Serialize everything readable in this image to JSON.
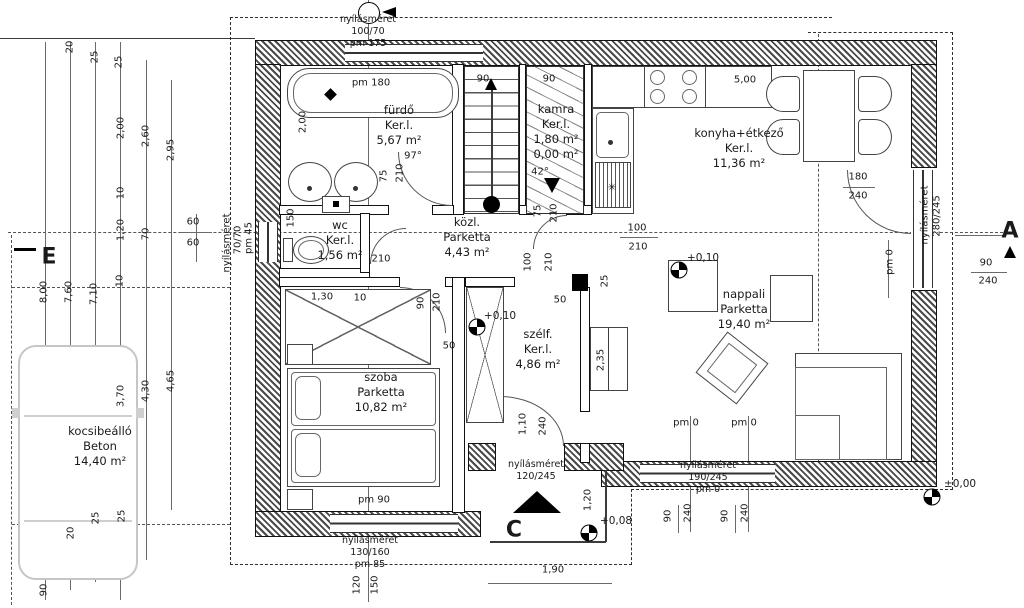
{
  "colors": {
    "line": "#1a1a1a",
    "wall_hatch": "#4a4a4a",
    "car_outline": "#c6c6c6"
  },
  "rooms": [
    {
      "name": "fürdő",
      "floor": "Ker.l.",
      "area": "5,67 m²",
      "x": 399,
      "y": 103
    },
    {
      "name": "wc",
      "floor": "Ker.l.",
      "area": "1,56 m²",
      "x": 340,
      "y": 218
    },
    {
      "name": "kamra",
      "floor": "Ker.l.",
      "area": "1,80 m²",
      "extra": "0,00 m²",
      "x": 556,
      "y": 102
    },
    {
      "name": "konyha+étkező",
      "floor": "Ker.l.",
      "area": "11,36 m²",
      "x": 739,
      "y": 126
    },
    {
      "name": "közl.",
      "floor": "Parketta",
      "area": "4,43 m²",
      "x": 467,
      "y": 215
    },
    {
      "name": "szélf.",
      "floor": "Ker.l.",
      "area": "4,86 m²",
      "x": 538,
      "y": 327
    },
    {
      "name": "nappali",
      "floor": "Parketta",
      "area": "19,40 m²",
      "x": 744,
      "y": 287
    },
    {
      "name": "szoba",
      "floor": "Parketta",
      "area": "10,82 m²",
      "x": 381,
      "y": 370
    },
    {
      "name": "kocsibeálló",
      "floor": "Beton",
      "area": "14,40 m²",
      "x": 100,
      "y": 424
    }
  ],
  "opening_notes": [
    {
      "lines": [
        "nyílásméret",
        "100/70",
        "pm 175"
      ],
      "x": 368,
      "y": 14
    },
    {
      "lines": [
        "nyílásméret",
        "130/160",
        "pm 85"
      ],
      "x": 370,
      "y": 535
    },
    {
      "lines": [
        "nyílásméret",
        "120/245"
      ],
      "x": 536,
      "y": 459
    },
    {
      "lines": [
        "nyílásméret",
        "190/245",
        "pm 0"
      ],
      "x": 708,
      "y": 460
    }
  ],
  "dims_h": [
    {
      "t": "60",
      "x": 193,
      "y": 222
    },
    {
      "t": "60",
      "x": 193,
      "y": 243
    },
    {
      "t": "90",
      "x": 483,
      "y": 79
    },
    {
      "t": "90",
      "x": 549,
      "y": 79
    },
    {
      "t": "5,00",
      "x": 745,
      "y": 80
    },
    {
      "t": "42°",
      "x": 540,
      "y": 172
    },
    {
      "t": "97°",
      "x": 413,
      "y": 156
    },
    {
      "t": "pm 180",
      "x": 371,
      "y": 83
    },
    {
      "t": "pm 90",
      "x": 374,
      "y": 500
    },
    {
      "t": "pm 0",
      "x": 686,
      "y": 423
    },
    {
      "t": "pm 0",
      "x": 744,
      "y": 423
    },
    {
      "t": "100",
      "x": 637,
      "y": 228
    },
    {
      "t": "210",
      "x": 638,
      "y": 247
    },
    {
      "t": "180",
      "x": 858,
      "y": 177
    },
    {
      "t": "240",
      "x": 858,
      "y": 196
    },
    {
      "t": "90",
      "x": 986,
      "y": 263
    },
    {
      "t": "240",
      "x": 988,
      "y": 281
    },
    {
      "t": "50",
      "x": 560,
      "y": 300
    },
    {
      "t": "50",
      "x": 449,
      "y": 346
    },
    {
      "t": "1,30",
      "x": 322,
      "y": 297
    },
    {
      "t": "10",
      "x": 360,
      "y": 298
    },
    {
      "t": "210",
      "x": 381,
      "y": 259
    },
    {
      "t": "1,90",
      "x": 553,
      "y": 570
    },
    {
      "t": "✳",
      "x": 612,
      "y": 188
    }
  ],
  "dims_v": [
    {
      "t": "20",
      "x": 70,
      "y": 47
    },
    {
      "t": "25",
      "x": 95,
      "y": 57
    },
    {
      "t": "25",
      "x": 119,
      "y": 62
    },
    {
      "t": "2,00",
      "x": 121,
      "y": 128
    },
    {
      "t": "2,60",
      "x": 146,
      "y": 136
    },
    {
      "t": "2,95",
      "x": 171,
      "y": 150
    },
    {
      "t": "10",
      "x": 121,
      "y": 193
    },
    {
      "t": "1,20",
      "x": 121,
      "y": 230
    },
    {
      "t": "70",
      "x": 146,
      "y": 234
    },
    {
      "t": "10",
      "x": 120,
      "y": 281
    },
    {
      "t": "8,00",
      "x": 44,
      "y": 292
    },
    {
      "t": "7,60",
      "x": 69,
      "y": 292
    },
    {
      "t": "7,10",
      "x": 94,
      "y": 294
    },
    {
      "t": "3,70",
      "x": 121,
      "y": 396
    },
    {
      "t": "4,30",
      "x": 146,
      "y": 391
    },
    {
      "t": "4,65",
      "x": 171,
      "y": 381
    },
    {
      "t": "20",
      "x": 71,
      "y": 533
    },
    {
      "t": "25",
      "x": 96,
      "y": 518
    },
    {
      "t": "25",
      "x": 122,
      "y": 516
    },
    {
      "t": "90",
      "x": 44,
      "y": 590
    },
    {
      "t": "120",
      "x": 357,
      "y": 585
    },
    {
      "t": "150",
      "x": 375,
      "y": 585
    },
    {
      "t": "2,00",
      "x": 303,
      "y": 122
    },
    {
      "t": "75",
      "x": 384,
      "y": 176
    },
    {
      "t": "210",
      "x": 400,
      "y": 173
    },
    {
      "t": "150",
      "x": 291,
      "y": 218
    },
    {
      "t": "90",
      "x": 421,
      "y": 303
    },
    {
      "t": "210",
      "x": 437,
      "y": 302
    },
    {
      "t": "75",
      "x": 538,
      "y": 211
    },
    {
      "t": "210",
      "x": 554,
      "y": 213
    },
    {
      "t": "100",
      "x": 528,
      "y": 262
    },
    {
      "t": "210",
      "x": 549,
      "y": 262
    },
    {
      "t": "25",
      "x": 605,
      "y": 281
    },
    {
      "t": "2,35",
      "x": 601,
      "y": 360
    },
    {
      "t": "1,10",
      "x": 523,
      "y": 424
    },
    {
      "t": "240",
      "x": 543,
      "y": 426
    },
    {
      "t": "1,20",
      "x": 588,
      "y": 500
    },
    {
      "t": "90",
      "x": 668,
      "y": 516
    },
    {
      "t": "240",
      "x": 688,
      "y": 513
    },
    {
      "t": "90",
      "x": 725,
      "y": 516
    },
    {
      "t": "240",
      "x": 745,
      "y": 513
    },
    {
      "t": "pm 0",
      "x": 890,
      "y": 262
    },
    {
      "t": "nyílásméret",
      "x": 227,
      "y": 243
    },
    {
      "t": "70/70",
      "x": 238,
      "y": 240
    },
    {
      "t": "pm 45",
      "x": 249,
      "y": 238
    },
    {
      "t": "nyílásméret",
      "x": 925,
      "y": 215
    },
    {
      "t": "280/245",
      "x": 937,
      "y": 216
    }
  ],
  "levels": [
    {
      "t": "+0,10",
      "tx": 703,
      "ty": 258,
      "cx": 679,
      "cy": 270
    },
    {
      "t": "+0,10",
      "tx": 500,
      "ty": 316,
      "cx": 477,
      "cy": 327
    },
    {
      "t": "+0,08",
      "tx": 616,
      "ty": 521,
      "cx": 589,
      "cy": 533
    },
    {
      "t": "±0,00",
      "tx": 960,
      "ty": 484,
      "cx": 932,
      "cy": 497
    }
  ],
  "markers": [
    {
      "t": "A",
      "x": 1010,
      "y": 231
    },
    {
      "t": "C",
      "x": 514,
      "y": 530
    },
    {
      "t": "E",
      "x": 49,
      "y": 257
    }
  ]
}
